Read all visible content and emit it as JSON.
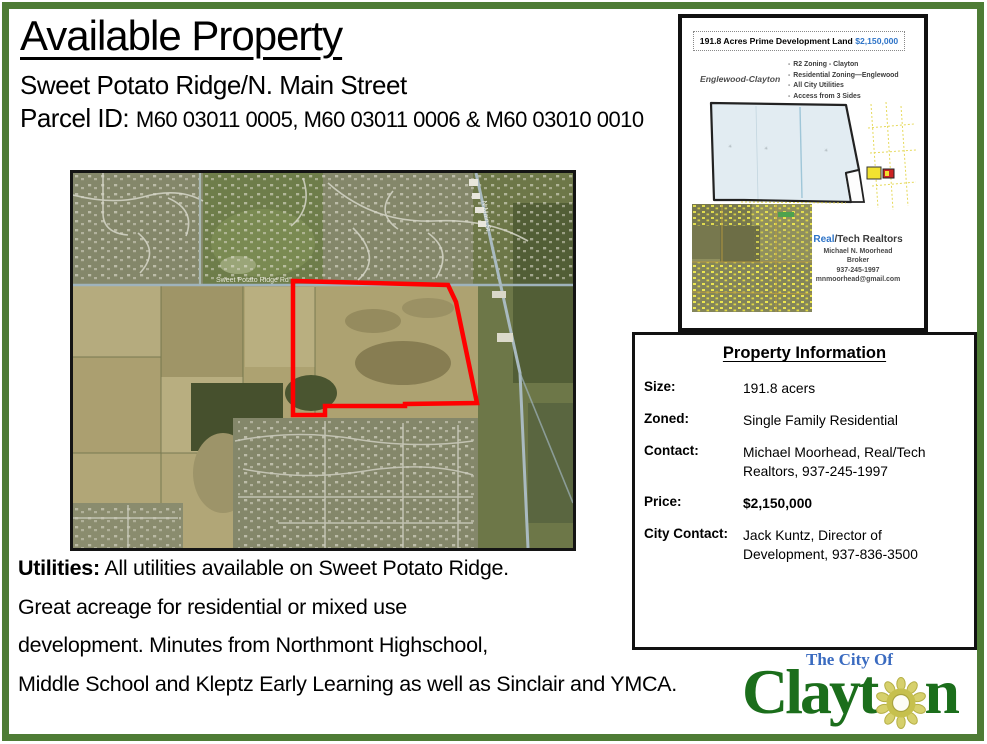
{
  "page": {
    "frame_color": "#4e7c35",
    "background": "#ffffff"
  },
  "header": {
    "title": "Available Property",
    "subtitle": "Sweet Potato Ridge/N. Main Street",
    "parcel_label": "Parcel ID: ",
    "parcel_ids": "M60 03011 0005, M60 03011 0006 & M60 03010 0010"
  },
  "map": {
    "outline_color": "#ff0000",
    "labels": {
      "horizontal_road": "Sweet Potato Ridge Rd",
      "diagonal_road": "N Main St"
    }
  },
  "utilities": {
    "label": "Utilities:",
    "line1": " All utilities available on Sweet Potato Ridge.",
    "line2": "Great acreage for residential or mixed use",
    "line3": "development. Minutes from Northmont Highschool,",
    "line4": "Middle School and Kleptz Early Learning as well as Sinclair and YMCA."
  },
  "flyer_thumbnail": {
    "headline": "191.8 Acres Prime Development Land ",
    "headline_price": "$2,150,000",
    "region_label": "Englewood-Clayton",
    "bullets": [
      "R2 Zoning - Clayton",
      "Residential Zoning—Englewood",
      "All City Utilities",
      "Access from 3 Sides"
    ],
    "realtor": {
      "name_blue": "Real",
      "name_rest": "/Tech Realtors",
      "agent": "Michael N. Moorhead",
      "title": "Broker",
      "phone": "937-245-1997",
      "email": "mnmoorhead@gmail.com"
    }
  },
  "property_info": {
    "title": "Property Information",
    "rows": [
      {
        "label": "Size:",
        "value": "191.8 acers"
      },
      {
        "label": "Zoned:",
        "value": "Single Family Residential"
      },
      {
        "label": "Contact:",
        "value": "Michael Moorhead, Real/Tech Realtors, 937-245-1997"
      },
      {
        "label": "Price:",
        "value": "$2,150,000"
      },
      {
        "label": "City Contact:",
        "value": "Jack Kuntz, Director of Development, 937-836-3500"
      }
    ]
  },
  "logo": {
    "tagline": "The City Of",
    "name_prefix": "Clayt",
    "name_suffix": "n",
    "green": "#1b6e1b",
    "blue": "#3a6bc0",
    "sun_color": "#c6c04d"
  }
}
